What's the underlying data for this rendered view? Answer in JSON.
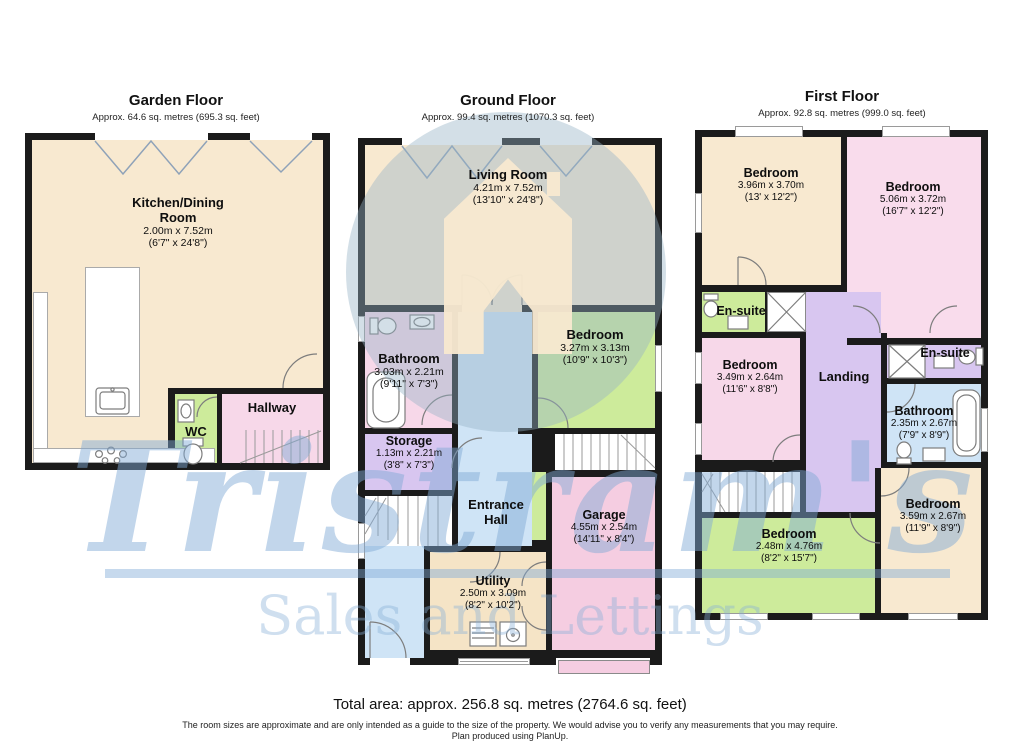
{
  "watermark": {
    "brand": "Tristram's",
    "tagline": "Sales and Lettings"
  },
  "floors": [
    {
      "title": "Garden Floor",
      "subtitle": "Approx. 64.6 sq. metres (695.3 sq. feet)",
      "rooms": [
        {
          "name": "Kitchen/Dining Room",
          "dim_m": "2.00m x 7.52m",
          "dim_ft": "(6'7\" x 24'8\")"
        },
        {
          "name": "WC"
        },
        {
          "name": "Hallway"
        }
      ]
    },
    {
      "title": "Ground Floor",
      "subtitle": "Approx. 99.4 sq. metres (1070.3 sq. feet)",
      "rooms": [
        {
          "name": "Living Room",
          "dim_m": "4.21m x 7.52m",
          "dim_ft": "(13'10\" x 24'8\")"
        },
        {
          "name": "Bathroom",
          "dim_m": "3.03m x 2.21m",
          "dim_ft": "(9'11\" x 7'3\")"
        },
        {
          "name": "Bedroom",
          "dim_m": "3.27m x 3.13m",
          "dim_ft": "(10'9\" x 10'3\")"
        },
        {
          "name": "Storage",
          "dim_m": "1.13m x 2.21m",
          "dim_ft": "(3'8\" x 7'3\")"
        },
        {
          "name": "Entrance Hall"
        },
        {
          "name": "Garage",
          "dim_m": "4.55m x 2.54m",
          "dim_ft": "(14'11\" x 8'4\")"
        },
        {
          "name": "Utility",
          "dim_m": "2.50m x 3.09m",
          "dim_ft": "(8'2\" x 10'2\")"
        }
      ]
    },
    {
      "title": "First Floor",
      "subtitle": "Approx. 92.8 sq. metres (999.0 sq. feet)",
      "rooms": [
        {
          "name": "Bedroom",
          "dim_m": "3.96m x 3.70m",
          "dim_ft": "(13' x 12'2\")"
        },
        {
          "name": "Bedroom",
          "dim_m": "5.06m x 3.72m",
          "dim_ft": "(16'7\" x 12'2\")"
        },
        {
          "name": "En-suite"
        },
        {
          "name": "Bedroom",
          "dim_m": "3.49m x 2.64m",
          "dim_ft": "(11'6\" x 8'8\")"
        },
        {
          "name": "Landing"
        },
        {
          "name": "En-suite"
        },
        {
          "name": "Bathroom",
          "dim_m": "2.35m x 2.67m",
          "dim_ft": "(7'9\" x 8'9\")"
        },
        {
          "name": "Bedroom",
          "dim_m": "2.48m x 4.76m",
          "dim_ft": "(8'2\" x 15'7\")"
        },
        {
          "name": "Bedroom",
          "dim_m": "3.59m x 2.67m",
          "dim_ft": "(11'9\" x 8'9\")"
        }
      ]
    }
  ],
  "footer": {
    "total_area": "Total area: approx. 256.8 sq. metres (2764.6 sq. feet)",
    "disclaimer": "The room sizes are approximate and are only intended as a guide to the size of the property. We would advise you to verify any measurements that you may require.",
    "produced": "Plan produced using PlanUp."
  },
  "colors": {
    "wall": "#1b1b1b",
    "cream": "#f8e9d0",
    "pink": "#f7d8e9",
    "garage_pink": "#f5cde1",
    "green": "#cdeb9b",
    "purple": "#d8c6f0",
    "blue": "#cfe4f6",
    "tan": "#f5e4c6",
    "watermark_blue": "#80aad6"
  }
}
